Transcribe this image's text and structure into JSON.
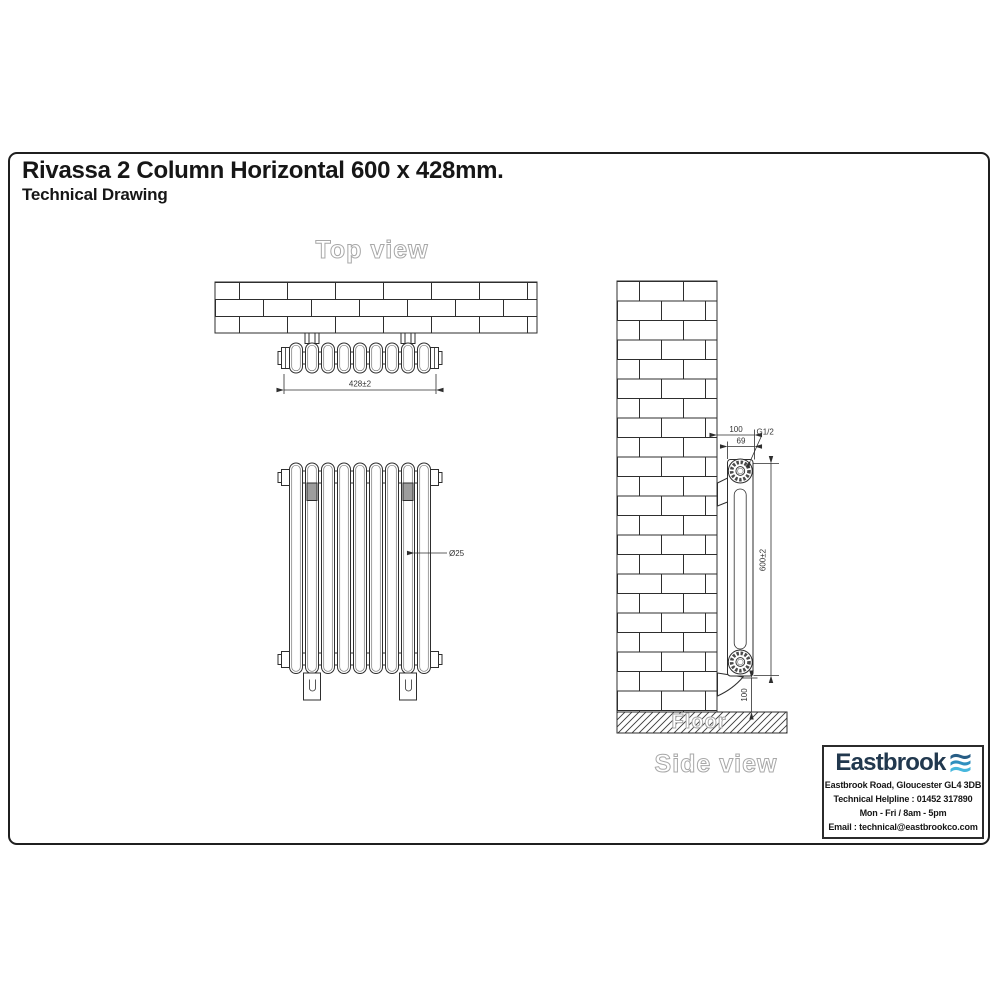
{
  "title": "Rivassa 2 Column Horizontal 600 x 428mm.",
  "subtitle": "Technical Drawing",
  "top_view": {
    "label": "Top view",
    "width_dim": "428±2"
  },
  "front_view": {
    "tube_dim": "Ø25"
  },
  "side_view": {
    "label": "Side view",
    "floor_label": "Floor",
    "depth_dim": "100",
    "tube_center_dim": "69",
    "connection_dim": "G1/2",
    "height_dim": "600±2",
    "floor_clearance_dim": "100"
  },
  "logo_box": {
    "brand": "Eastbrook",
    "address": "Eastbrook Road, Gloucester GL4 3DB",
    "helpline": "Technical Helpline : 01452 317890",
    "hours": "Mon - Fri / 8am - 5pm",
    "email": "Email : technical@eastbrookco.com"
  },
  "colors": {
    "line": "#2e2e2e",
    "label_outline": "#a8a8a8",
    "brand_navy": "#21384e",
    "wave_top": "#275d85",
    "wave_mid": "#2f8fbe",
    "wave_bottom": "#46b7dd"
  }
}
